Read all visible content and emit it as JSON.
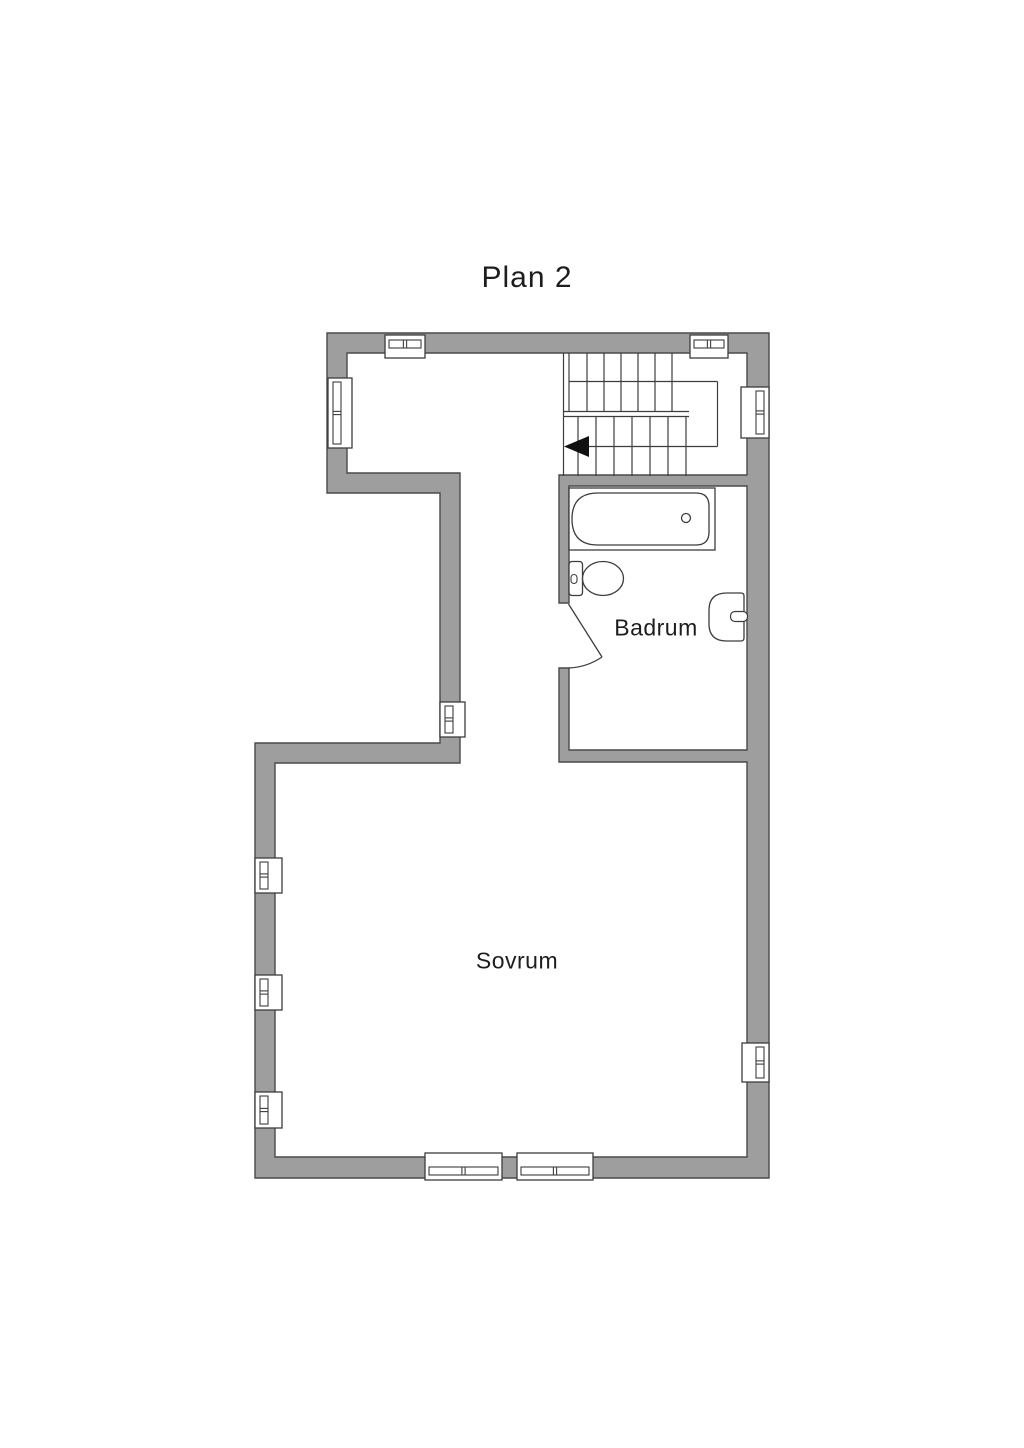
{
  "title": "Plan 2",
  "colors": {
    "background": "#ffffff",
    "wall_fill": "#9e9e9e",
    "wall_stroke": "#4a4a4a",
    "line": "#3d3d3d",
    "fixture_fill": "#ffffff",
    "text": "#1d1d1d"
  },
  "rooms": [
    {
      "id": "badrum",
      "label": "Badrum",
      "x": 656,
      "y": 628
    },
    {
      "id": "sovrum",
      "label": "Sovrum",
      "x": 517,
      "y": 961
    }
  ],
  "walls": {
    "path": "M327,333 H769 V1178 H255 V743 H440 V493 H327 Z M347,353 H747 V475 H559 V603 H569 V486 H747 V750 H569 V668 H559 V762 H747 V1157 H275 V763 H460 V473 H347 Z"
  },
  "windows": [
    {
      "id": "window-top-left",
      "x": 385,
      "y": 335,
      "w": 40,
      "h": 23,
      "side": "n"
    },
    {
      "id": "window-top-right",
      "x": 690,
      "y": 335,
      "w": 38,
      "h": 23,
      "side": "n"
    },
    {
      "id": "window-left-upper",
      "x": 328,
      "y": 378,
      "w": 24,
      "h": 70,
      "side": "w"
    },
    {
      "id": "window-right-upper",
      "x": 741,
      "y": 387,
      "w": 28,
      "h": 51,
      "side": "e"
    },
    {
      "id": "window-hall-west",
      "x": 440,
      "y": 702,
      "w": 25,
      "h": 35,
      "side": "w"
    },
    {
      "id": "window-left-mid-1",
      "x": 255,
      "y": 858,
      "w": 27,
      "h": 35,
      "side": "w"
    },
    {
      "id": "window-left-mid-2",
      "x": 255,
      "y": 975,
      "w": 27,
      "h": 35,
      "side": "w"
    },
    {
      "id": "window-left-mid-3",
      "x": 255,
      "y": 1092,
      "w": 27,
      "h": 36,
      "side": "w"
    },
    {
      "id": "window-right-lower",
      "x": 742,
      "y": 1043,
      "w": 27,
      "h": 39,
      "side": "e"
    },
    {
      "id": "window-bottom-left",
      "x": 425,
      "y": 1153,
      "w": 77,
      "h": 27,
      "side": "s"
    },
    {
      "id": "window-bottom-right",
      "x": 517,
      "y": 1153,
      "w": 76,
      "h": 27,
      "side": "s"
    }
  ],
  "stairs": {
    "vlines": [
      {
        "x": 563.5,
        "y1": 353,
        "y2": 476
      },
      {
        "x": 569,
        "y1": 353,
        "y2": 411.5
      },
      {
        "x": 587,
        "y1": 353,
        "y2": 411.5
      },
      {
        "x": 604,
        "y1": 353,
        "y2": 411.5
      },
      {
        "x": 621,
        "y1": 353,
        "y2": 411.5
      },
      {
        "x": 638,
        "y1": 353,
        "y2": 411.5
      },
      {
        "x": 655,
        "y1": 353,
        "y2": 411.5
      },
      {
        "x": 672,
        "y1": 353,
        "y2": 411.5
      },
      {
        "x": 717.5,
        "y1": 381.5,
        "y2": 446.5
      },
      {
        "x": 578,
        "y1": 416.5,
        "y2": 476
      },
      {
        "x": 596,
        "y1": 416.5,
        "y2": 476
      },
      {
        "x": 614,
        "y1": 416.5,
        "y2": 476
      },
      {
        "x": 632,
        "y1": 416.5,
        "y2": 476
      },
      {
        "x": 650,
        "y1": 416.5,
        "y2": 476
      },
      {
        "x": 668,
        "y1": 416.5,
        "y2": 476
      },
      {
        "x": 686,
        "y1": 416.5,
        "y2": 476
      }
    ],
    "hlines": [
      {
        "y": 381.5,
        "x1": 569,
        "x2": 717.5
      },
      {
        "y": 411.5,
        "x1": 563.5,
        "x2": 689
      },
      {
        "y": 416.5,
        "x1": 563.5,
        "x2": 689
      },
      {
        "y": 446.5,
        "x1": 586,
        "x2": 717.5
      }
    ],
    "arrow_points": "564,446.5 589,436 589,457"
  },
  "fixtures": {
    "bathtub": {
      "outer": {
        "x": 569,
        "y": 488,
        "w": 146,
        "h": 62
      },
      "inner_path": "M598,493 L696,493 Q709,493 709,506 L709,532 Q709,545 696,545 L598,545 Q572,545 572,519 Q572,493 598,493 Z",
      "drain": {
        "cx": 686,
        "cy": 518,
        "r": 4.5
      }
    },
    "toilet": {
      "tank": {
        "x": 569,
        "y": 561.5,
        "w": 13.5,
        "h": 34,
        "r": 3
      },
      "button": {
        "x": 571,
        "y": 574.5,
        "w": 6,
        "h": 9,
        "r": 3
      },
      "bowl": {
        "cx": 603,
        "cy": 578.5,
        "rx": 20.5,
        "ry": 17
      }
    },
    "sink": {
      "body_path": "M727,593 L741,593 Q744,593 744,596 L744,638 Q744,641 741,641 L727,641 Q709,641 709,624 L709,610 Q709,593 727,593 Z",
      "faucet": {
        "x": 730.5,
        "y": 611.5,
        "w": 17,
        "h": 10,
        "r": 4.5
      }
    },
    "door": {
      "leaf": {
        "x1": 568.5,
        "y1": 604,
        "x2": 602,
        "y2": 657
      },
      "arc_path": "M602,657 A63.5,63.5 0 0 1 568.5,668"
    }
  }
}
